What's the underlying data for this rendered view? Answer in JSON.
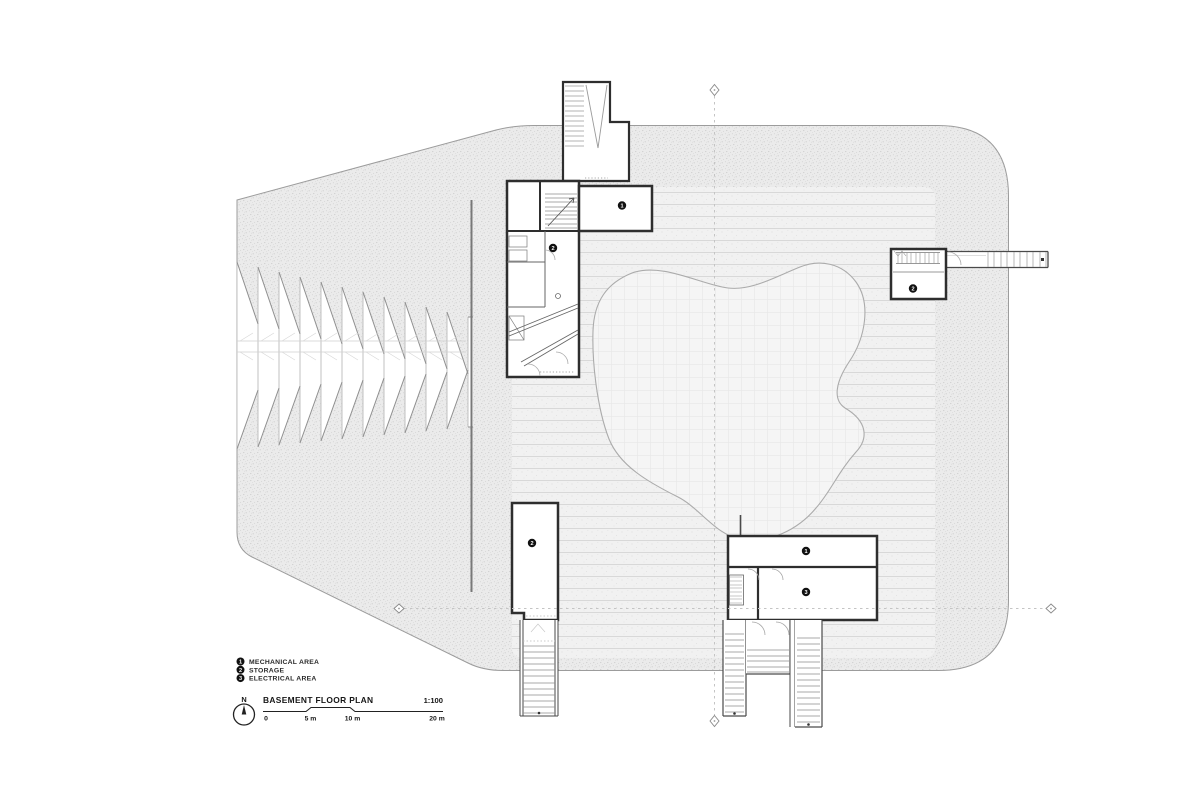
{
  "drawing": {
    "titleblock": {
      "north_label": "N",
      "title": "BASEMENT FLOOR PLAN",
      "scale": "1:100",
      "scalebar_labels": [
        "0",
        "5 m",
        "10 m",
        "20 m"
      ]
    },
    "legend": {
      "items": [
        {
          "number": "1",
          "label": "MECHANICAL AREA"
        },
        {
          "number": "2",
          "label": "STORAGE"
        },
        {
          "number": "3",
          "label": "ELECTRICAL AREA"
        }
      ]
    },
    "markers": [
      {
        "number": "1"
      },
      {
        "number": "2"
      },
      {
        "number": "2"
      },
      {
        "number": "2"
      },
      {
        "number": "1"
      },
      {
        "number": "3"
      }
    ],
    "colors": {
      "wall": "#2e2e2e",
      "site_fill": "#ebebeb",
      "paving_fill": "#f1f1f1",
      "pond_fill": "#f5f5f5",
      "line_gray": "#8f8f8f",
      "text": "#161616"
    }
  }
}
